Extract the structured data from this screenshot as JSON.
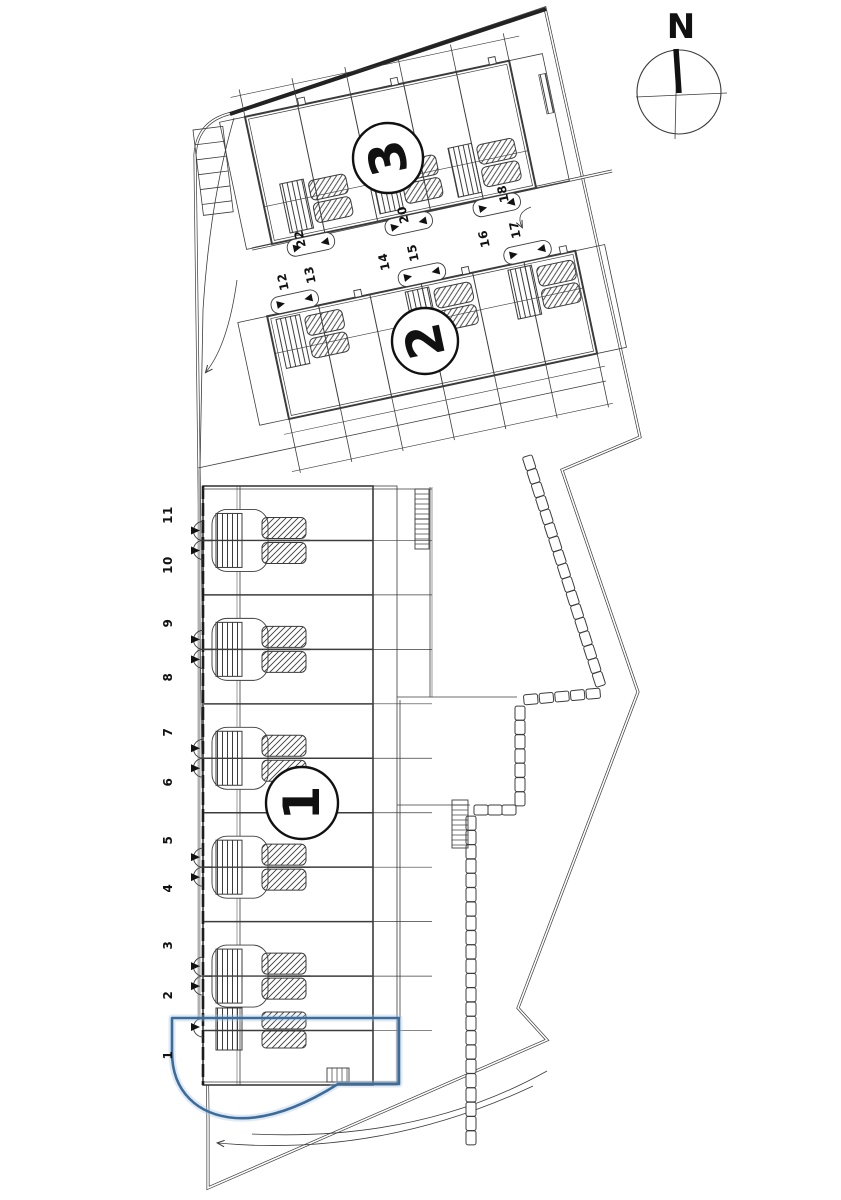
{
  "compass": {
    "label": "N"
  },
  "badges": {
    "b1": "1",
    "b2": "2",
    "b3": "3"
  },
  "units_b1": [
    "11",
    "10",
    "9",
    "8",
    "7",
    "6",
    "5",
    "4",
    "3",
    "2",
    "1"
  ],
  "units_upper": [
    "22",
    "20",
    "18",
    "12",
    "13",
    "14",
    "15",
    "16",
    "17"
  ],
  "highlight": {
    "unit": "1",
    "color": "#3a6d9e",
    "glow": "#a8c4de"
  },
  "ink": {
    "line": "#3c3c3c",
    "dark": "#111111"
  }
}
